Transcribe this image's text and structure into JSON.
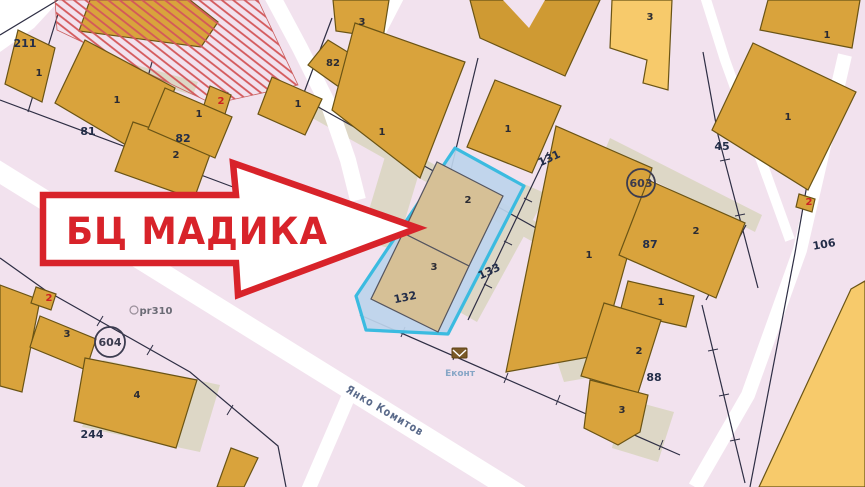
{
  "map": {
    "arrow": {
      "label": "БЦ МАДИКА"
    },
    "street": {
      "name": "Янко Комитов"
    },
    "markers": {
      "pr_label": "pr310",
      "econt_label": "Еконт"
    },
    "zone_circles": [
      {
        "id": "603"
      },
      {
        "id": "604"
      }
    ],
    "parcel_numbers": [
      "211",
      "81",
      "82",
      "131",
      "133",
      "132",
      "87",
      "45",
      "106",
      "88",
      "244"
    ],
    "building_numbers": [
      "1",
      "1",
      "2",
      "3",
      "82",
      "1",
      "1",
      "1",
      "1",
      "2",
      "3",
      "1",
      "2",
      "1",
      "1",
      "3",
      "1",
      "2",
      "3",
      "3",
      "4"
    ],
    "red_building_numbers": [
      "2",
      "2",
      "2"
    ]
  },
  "colors": {
    "background": "#f2e2ee",
    "road": "#ffffff",
    "building": "#d9a33c",
    "building_light": "#f7ca6b",
    "building_beige": "#d6c096",
    "shadow": "#ddd7c6",
    "highlight_fill": "#bdd4ec",
    "highlight_border": "#3bbbe0",
    "hatch": "#d4575a",
    "arrow_red": "#d8232a",
    "boundary": "#2e2e44",
    "label_red": "#cc2222",
    "street_label": "#5a6a8a",
    "econt_blue": "#87a6c6"
  }
}
